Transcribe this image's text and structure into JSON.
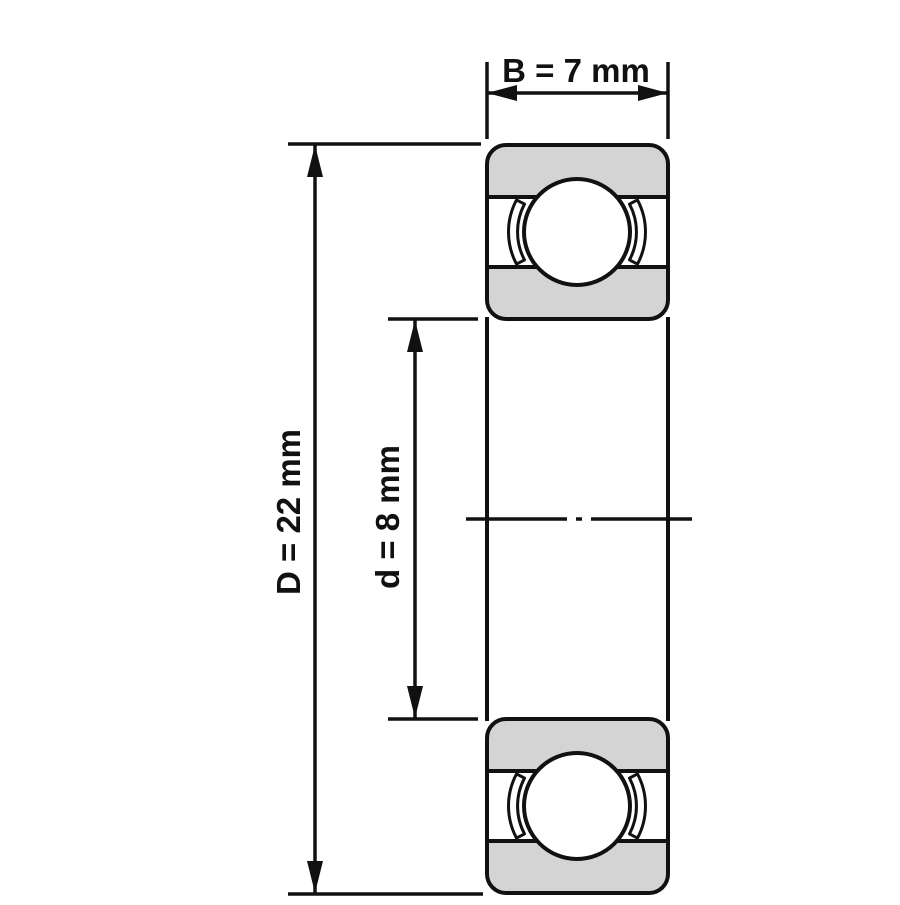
{
  "diagram": {
    "title": "Deep groove ball bearing cross-section technical drawing",
    "labels": {
      "width": "B = 7 mm",
      "outer_diameter": "D = 22 mm",
      "bore_diameter": "d = 8 mm"
    },
    "values": {
      "B_mm": 7,
      "D_mm": 22,
      "d_mm": 8,
      "unit": "mm"
    },
    "colors": {
      "line": "#111111",
      "ring_fill": "#d4d4d4",
      "ball_fill": "#ffffff",
      "background": "#ffffff"
    }
  }
}
